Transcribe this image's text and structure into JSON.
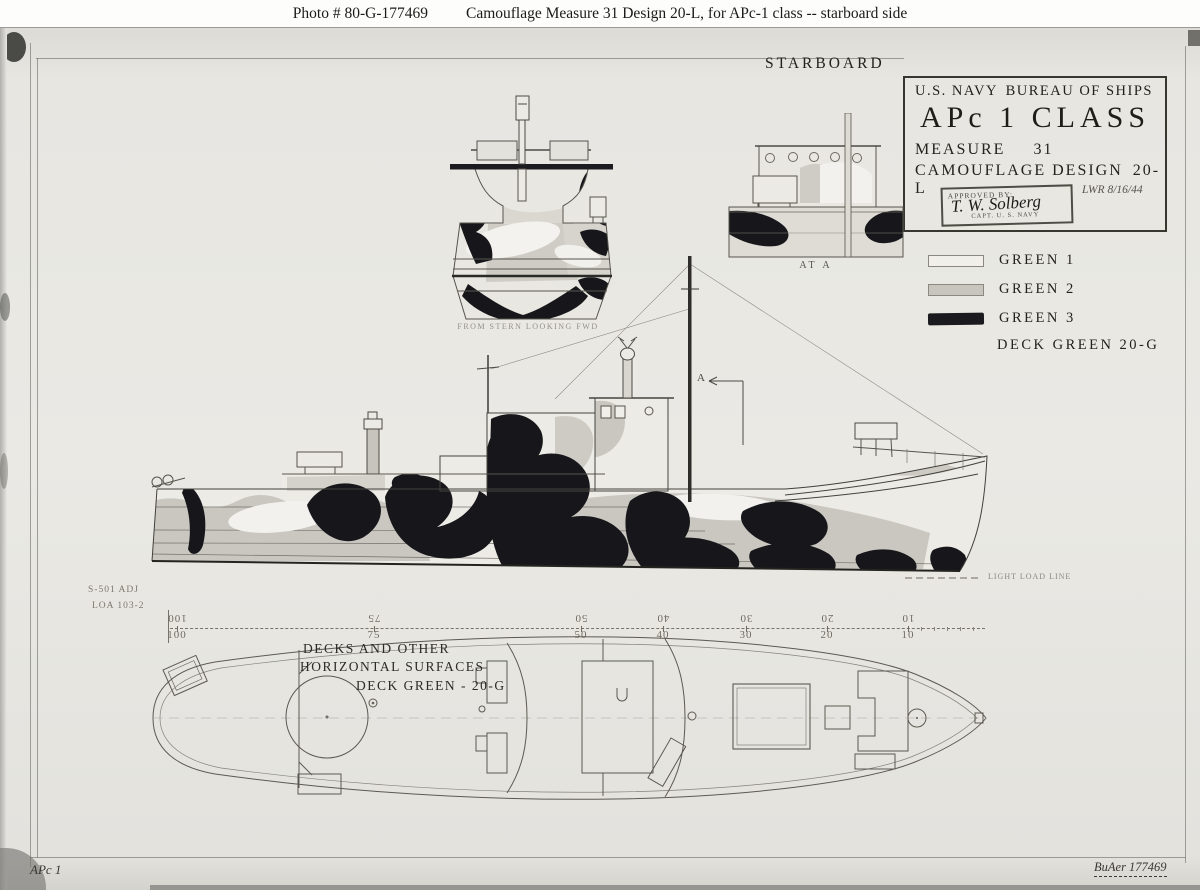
{
  "caption": {
    "photo_id": "Photo #  80-G-177469",
    "title": "Camouflage Measure 31 Design 20-L, for APc-1 class -- starboard side"
  },
  "title_block": {
    "agency": "U.S. NAVY",
    "bureau": "BUREAU OF SHIPS",
    "ship_class": "APc 1 CLASS",
    "measure_label": "MEASURE",
    "measure_value": "31",
    "design_label": "CAMOUFLAGE DESIGN",
    "design_value": "20-L",
    "stamp": {
      "approved_by": "APPROVED BY:",
      "signature": "T. W. Solberg",
      "rank": "CAPT. U. S. NAVY"
    },
    "date_note": "LWR 8/16/44"
  },
  "legend": {
    "items": [
      {
        "label": "GREEN 1",
        "swatch": "#f0efea"
      },
      {
        "label": "GREEN 2",
        "swatch": "#c7c5bd"
      },
      {
        "label": "GREEN 3",
        "swatch": "#1b1b1f"
      }
    ],
    "deck_label": "DECK GREEN 20-G"
  },
  "labels": {
    "starboard": "STARBOARD",
    "stern_view": "FROM STERN LOOKING FWD",
    "section_view": "AT A",
    "section_marker": "A",
    "waterline": "LIGHT LOAD LINE",
    "plan_line1": "DECKS AND OTHER",
    "plan_line2": "HORIZONTAL SURFACES",
    "plan_line3": "DECK GREEN - 20-G",
    "footer_left": "APc 1",
    "footer_right": "BuAer 177469"
  },
  "scale": {
    "note_top": "S-501 ADJ",
    "note_bottom": "LOA 103-2",
    "stations": [
      {
        "label": "100"
      },
      {
        "label": "75"
      },
      {
        "label": "50"
      },
      {
        "label": "40"
      },
      {
        "label": "30"
      },
      {
        "label": "20"
      },
      {
        "label": "10"
      }
    ]
  },
  "colors": {
    "paper": "#e9e8e3",
    "green1": "#f0efea",
    "green2": "#c7c5bd",
    "green3": "#1b1b1f",
    "pencil": "#55534c"
  }
}
